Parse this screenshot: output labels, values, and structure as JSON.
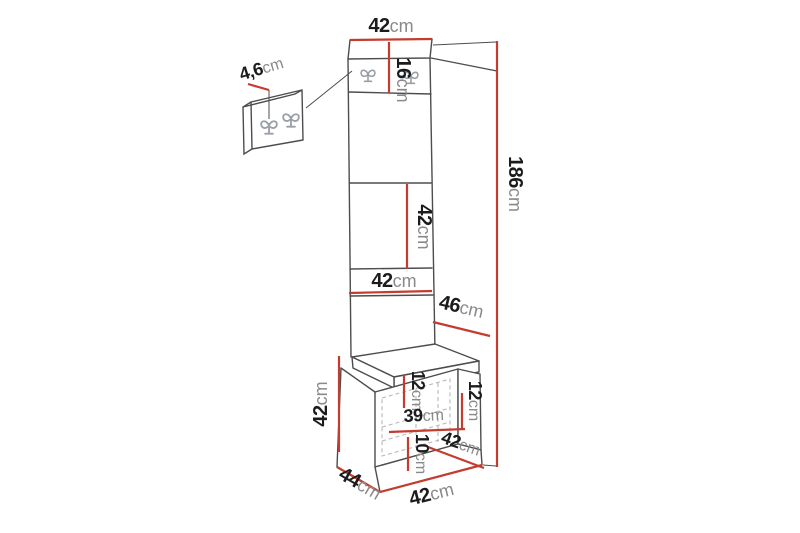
{
  "colors": {
    "dimension_line": "#c63b30",
    "drawing_line": "#4d4d4d",
    "hook_gray": "#9aa0a6",
    "number_text": "#1c1c1c",
    "unit_text": "#8a8a8a",
    "background": "#ffffff"
  },
  "icons": {
    "coat_hook": "double-coat-hook-icon"
  },
  "dims": {
    "top_width": {
      "value": "42",
      "unit": "cm"
    },
    "hook_strip_height": {
      "value": "16",
      "unit": "cm"
    },
    "hook_panel_thickness": {
      "value": "4,6",
      "unit": "cm"
    },
    "total_height": {
      "value": "186",
      "unit": "cm"
    },
    "middle_panel_height": {
      "value": "42",
      "unit": "cm"
    },
    "lower_panel_width": {
      "value": "42",
      "unit": "cm"
    },
    "upper_side_depth": {
      "value": "46",
      "unit": "cm"
    },
    "bench_height": {
      "value": "42",
      "unit": "cm"
    },
    "bench_inner_top_left": {
      "value": "12",
      "unit": "cm"
    },
    "bench_inner_top_right": {
      "value": "12",
      "unit": "cm"
    },
    "bench_inner_width": {
      "value": "39",
      "unit": "cm"
    },
    "bench_inner_bottom": {
      "value": "10",
      "unit": "cm"
    },
    "bench_seat_depth": {
      "value": "42",
      "unit": "cm"
    },
    "bench_depth": {
      "value": "44",
      "unit": "cm"
    },
    "bench_width": {
      "value": "42",
      "unit": "cm"
    }
  }
}
